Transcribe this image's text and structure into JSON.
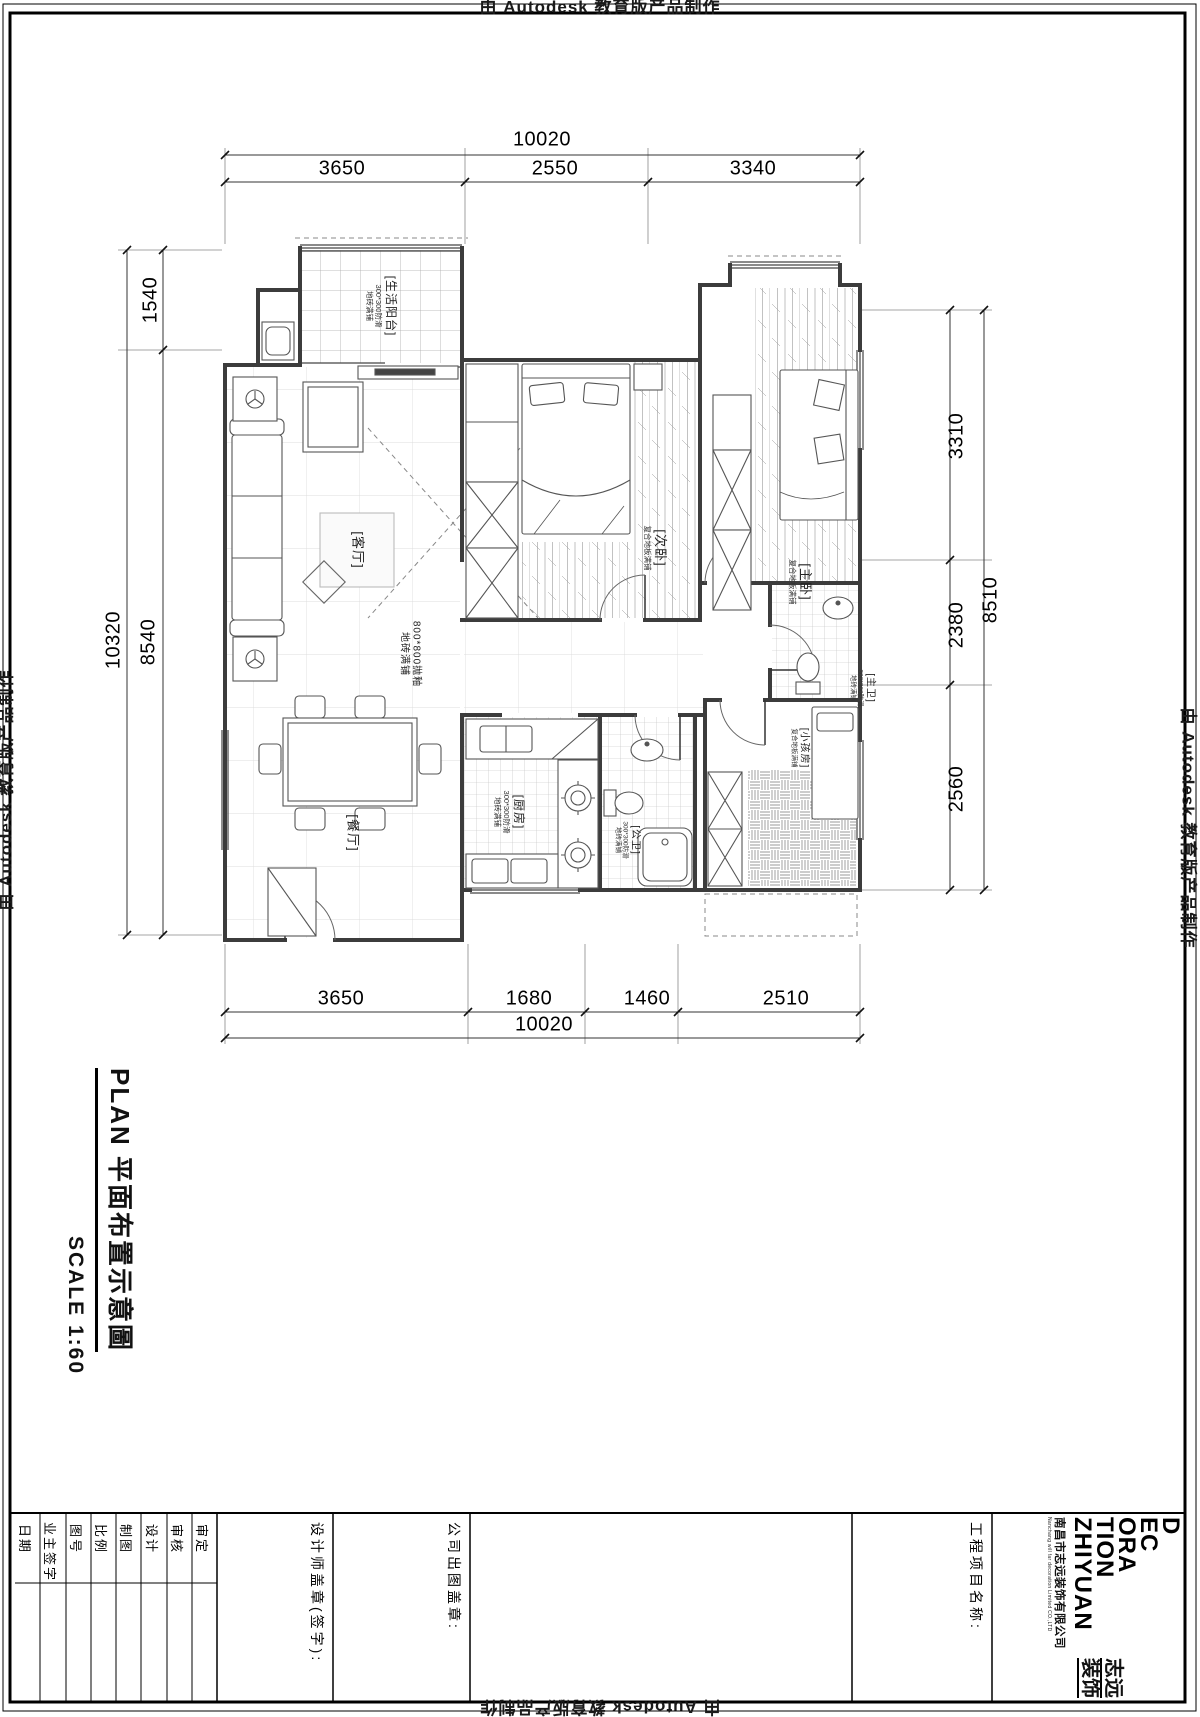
{
  "watermark": "由 Autodesk 教育版产品制作",
  "sheet": {
    "title": "PLAN  平面布置示意圖",
    "scale": "SCALE  1:60"
  },
  "plan": {
    "rooms": [
      {
        "name": "生活阳台",
        "label": "[生活阳台]",
        "floor1": "300*300防滑",
        "floor2": "地砖满铺"
      },
      {
        "name": "客厅",
        "label": "[客厅]"
      },
      {
        "name": "次卧",
        "label": "[次卧]",
        "floor1": "复合地板满铺"
      },
      {
        "name": "主卧",
        "label": "[主卧]",
        "floor1": "复合地板满铺"
      },
      {
        "name": "主卫",
        "label": "[主卫]",
        "floor1": "300*300防滑",
        "floor2": "地砖满铺"
      },
      {
        "name": "小孩房",
        "label": "[小孩房]",
        "floor1": "复合地板满铺"
      },
      {
        "name": "厨房",
        "label": "[厨房]",
        "floor1": "300*300防滑",
        "floor2": "地砖满铺"
      },
      {
        "name": "公卫",
        "label": "[公卫]",
        "floor1": "300*300防滑",
        "floor2": "地砖满铺"
      },
      {
        "name": "餐厅",
        "label": "[餐厅]"
      },
      {
        "name": "过道",
        "label": "800*800抛釉",
        "floor1": "地砖满铺"
      }
    ],
    "dimensions": {
      "top": {
        "overall": "10020",
        "segments": [
          "3650",
          "2550",
          "3340"
        ]
      },
      "bottom": {
        "overall": "10020",
        "segments": [
          "3650",
          "1680",
          "1460",
          "2510"
        ]
      },
      "left": {
        "overall": "10320",
        "segments": [
          "1540",
          "8540"
        ]
      },
      "right": {
        "overall": "8510",
        "segments": [
          "3310",
          "2380",
          "2560"
        ]
      }
    }
  },
  "title_block": {
    "fields": [
      "日期",
      "业主签字",
      "图号",
      "比例",
      "制图",
      "设计",
      "审核",
      "审定"
    ],
    "designer_stamp": "设计师盖章(签字):",
    "company_stamp": "公司出图盖章:",
    "project_name": "工程项目名称:",
    "logo": {
      "en_lines": [
        "D",
        "EC",
        "ORA",
        "TION",
        "ZHIYUAN"
      ],
      "cn_line1": "志远",
      "cn_line2": "装饰",
      "company_cn": "南昌市志远装饰有限公司",
      "company_en": "Nanchang will far decoration Limited CO.,LTD"
    }
  }
}
